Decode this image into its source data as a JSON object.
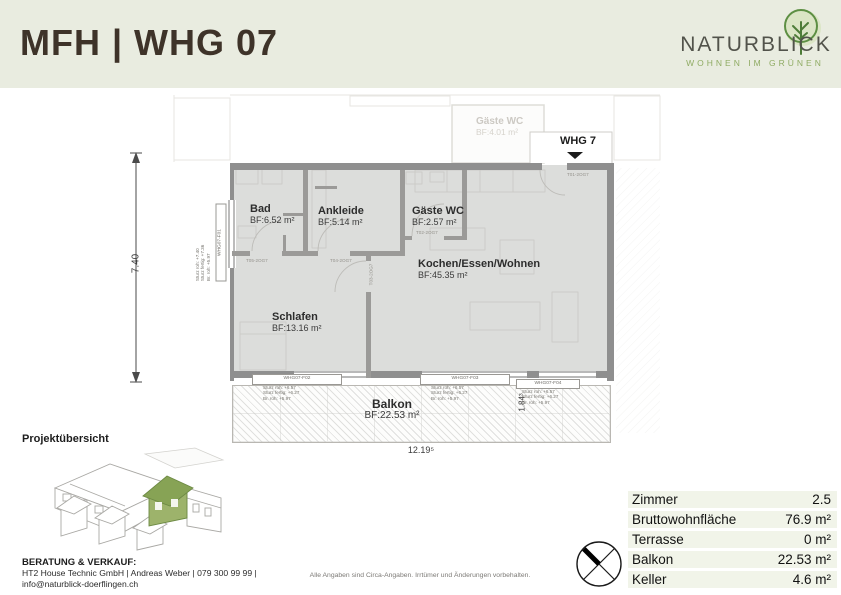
{
  "header": {
    "title": "MFH | WHG 07",
    "logo": {
      "name": "NATURBLICK",
      "tagline": "WOHNEN IM GRÜNEN"
    }
  },
  "colors": {
    "header_bg": "#e9ece0",
    "title_brown": "#3e3329",
    "logo_green": "#8fab63",
    "room_fill": "#dcdddb",
    "wall_grey": "#8f8f8f",
    "highlight_house_green": "#8fae5e",
    "summary_row_bg": "#f1f4e9"
  },
  "plan": {
    "unit_label": "WHG 7",
    "rooms": [
      {
        "name": "Bad",
        "area": "BF:6.52 m²"
      },
      {
        "name": "Ankleide",
        "area": "BF:5.14 m²"
      },
      {
        "name": "Gäste WC",
        "area": "BF:2.57 m²"
      },
      {
        "name": "Kochen/Essen/Wohnen",
        "area": "BF:45.35 m²"
      },
      {
        "name": "Schlafen",
        "area": "BF:13.16 m²"
      },
      {
        "name": "Balkon",
        "area": "BF:22.53 m²"
      }
    ],
    "neighbor_room": {
      "name": "Gäste WC",
      "area": "BF:4.01 m²"
    },
    "dims": {
      "height": "7.40",
      "width": "12.19⁵",
      "balcony_depth": "1.84³"
    },
    "doors": [
      "T05-2OG7",
      "T04-2OG7",
      "T02-2OG7",
      "T03-2OG7",
      "T01-2OG7"
    ],
    "windows": {
      "f01": {
        "id": "WHG07-F01",
        "l1": "Sturz roh: +7.40",
        "l2": "Sturz fertig: +7.36",
        "l3": "Br. roh: +5.97"
      },
      "f02": {
        "id": "WHG07-F02",
        "l1": "Sturz roh: +6.57",
        "l2": "Sturz fertig: +6.27",
        "l3": "Br. roh: +5.97"
      },
      "f03": {
        "id": "WHG07-F03",
        "l1": "Sturz roh: +6.57",
        "l2": "Sturz fertig: +6.27",
        "l3": "Br. roh: +5.97"
      },
      "f04": {
        "id": "WHG07-F04",
        "l1": "Sturz roh: +6.57",
        "l2": "Sturz fertig: +6.27",
        "l3": "Br. roh: +5.97"
      }
    }
  },
  "project": {
    "heading": "Projektübersicht"
  },
  "contact": {
    "heading": "BERATUNG & VERKAUF:",
    "line1": "HT2 House Technic GmbH | Andreas Weber | 079 300 99 99 |",
    "line2": "info@naturblick-doerflingen.ch"
  },
  "disclaimer": "Alle Angaben sind Circa-Angaben. Irrtümer und Änderungen vorbehalten.",
  "summary": {
    "rows": [
      {
        "label": "Zimmer",
        "value": "2.5"
      },
      {
        "label": "Bruttowohnfläche",
        "value": "76.9 m²"
      },
      {
        "label": "Terrasse",
        "value": "0 m²"
      },
      {
        "label": "Balkon",
        "value": "22.53 m²"
      },
      {
        "label": "Keller",
        "value": "4.6 m²"
      }
    ]
  }
}
